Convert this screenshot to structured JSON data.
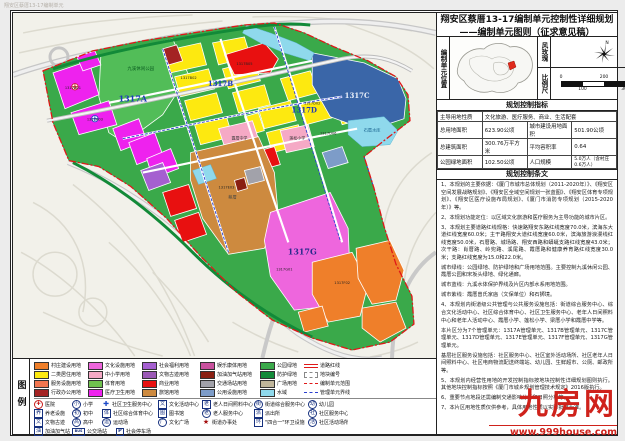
{
  "corner_note": "翔安区蔡厝13-17编制单元",
  "title": {
    "line1": "翔安区蔡厝13-17编制单元控制性详细规划",
    "line2": "——编制单元图则（征求意见稿）"
  },
  "panels": {
    "unit_location_label": "编制单元位置",
    "wind_rose_label": "风玫瑰",
    "north_label": "N",
    "scale_label": "比例尺",
    "scale_ticks_top": [
      "0",
      "200",
      "400m"
    ],
    "scale_ticks_bottom": [
      "100",
      "300"
    ]
  },
  "indicators": {
    "title": "规划控制指标",
    "rows": [
      [
        {
          "t": "主导用地性质"
        },
        {
          "t": "文化旅游、医疗服务、商业、生活配套",
          "span": 3
        }
      ],
      [
        {
          "t": "总用地面积"
        },
        {
          "t": "623.90公顷"
        },
        {
          "t": "城市建设用地面积"
        },
        {
          "t": "501.90公顷"
        }
      ],
      [
        {
          "t": "总建筑面积"
        },
        {
          "t": "300.76万平方米"
        },
        {
          "t": "平均容积率"
        },
        {
          "t": "0.64"
        }
      ],
      [
        {
          "t": "公园绿地面积"
        },
        {
          "t": "102.50公顷"
        },
        {
          "t": "人口规模"
        },
        {
          "t": "5.0万人（含村庄0.6万人）",
          "small": true
        }
      ]
    ]
  },
  "provisions": {
    "title": "规划控制条文",
    "paragraphs": [
      "1、本规划的主要依据：《厦门市城市总体规划（2011-2020年）》、《翔安区空间发展战略规划》、《翔安区全域空间规划一张蓝图》、《翔安区体育专项规划》、《翔安区医疗设施布局规划》、《厦门市消防专项规划（2015-2020年）》等。",
      "2、本规划功能定位：以区域文化旅游和医疗服务为主导功能的城市片区。",
      "3、本规划主要道路红线规格：快速路翔安东路红线宽度70.0米，滨海东大道红线宽度60.0米；主干路翔安大道红线宽度60.0米，滨海旅游浪漫线红线宽度50.0米，石厝路、城场路、翔安西路和蟒蜒支路红线宽度43.0米；次干路：肖厝路、岭兜路、溪尾路、霞厝路和健康养育路红线宽度30.0米；支路红线宽度为15.0和22.0米。",
      "城市绿线：公园绿地、防护绿地和广场用地范围。主要控制九溪休闲公园、霞厝公园和宋坂头绿地、绿化通廊。",
      "城市蓝线：九溪水体保护界线及片区内部水系用地范围。",
      "城市紫线：霞厝曾氏家庙（文保单位）和石狮境。",
      "4、本规划内街道级公共管理与公共服务设施包括：街道综合服务中心、综合文化活动中心、社区综合体育中心、社区卫生服务中心、老年人日间照料中心和老年人活动中心、霞厝小学、莲松小学、梁厝小学和霞厝中学等。",
      "本片区分为7个管理单元：1317A管理单元、1317B管理单元、1317C管理单元、1317D管理单元、1317E管理单元、1317F管理单元、1317G管理单元。",
      "基层社区服务设施包括：社区服务中心、社区室外活动场所、社区老年人日间照料中心、社区电商物流配送终端站、幼儿园、生鲜超市、公厕、邮政所等。",
      "5、本规划内经营性用地的开发控制指标按地块控制性详细规划图则执行。其他地块控制指标按照《厦门市城乡规划管理技术规定》2016版执行。",
      "6、重要节点地段还需编制交通影响分析和日照分析等。",
      "7、本片区用地性质仅供参考，具体用地性质以实际批准为准。"
    ]
  },
  "legend": {
    "side_label": "图例",
    "color_rows": [
      [
        {
          "label": "村庄建设用地",
          "color": "#ef7f2a",
          "type": "fill",
          "w": 54
        },
        {
          "label": "文化设施用地",
          "color": "#ee66dd",
          "type": "fill",
          "w": 54
        },
        {
          "label": "社会福利用地",
          "color": "#a55fd0",
          "type": "fill",
          "w": 58
        },
        {
          "label": "娱乐康体用地",
          "color": "#c9519e",
          "type": "fill",
          "w": 60
        },
        {
          "label": "公园绿地",
          "color": "#3aa94a",
          "type": "fill",
          "w": 44
        },
        {
          "label": "道路红线",
          "color": "#e01818",
          "type": "road-line",
          "w": 54
        }
      ],
      [
        {
          "label": "二类居住用地",
          "color": "#fde910",
          "type": "fill",
          "w": 54
        },
        {
          "label": "中小学用地",
          "color": "#f5a9c5",
          "type": "fill",
          "w": 54
        },
        {
          "label": "文物古迹用地",
          "color": "#9b59b6",
          "type": "fill",
          "w": 58
        },
        {
          "label": "加油加气站用地",
          "color": "#8a1f12",
          "type": "fill",
          "w": 60
        },
        {
          "label": "防护绿地",
          "color": "#128a38",
          "type": "fill",
          "w": 44
        },
        {
          "label": "地块编号",
          "color": "#888888",
          "type": "dash-box",
          "w": 54
        }
      ],
      [
        {
          "label": "服务设施用地",
          "color": "#f2764f",
          "type": "fill",
          "w": 54
        },
        {
          "label": "体育用地",
          "color": "#6fc24e",
          "type": "fill",
          "w": 54
        },
        {
          "label": "商业用地",
          "color": "#e81010",
          "type": "fill",
          "w": 58
        },
        {
          "label": "交通场站用地",
          "color": "#a2a2aa",
          "type": "fill",
          "w": 60
        },
        {
          "label": "广场用地",
          "color": "#c0b69b",
          "type": "fill",
          "w": 44
        },
        {
          "label": "编制单元范围",
          "color": "#e01818",
          "type": "dashdot-red",
          "w": 54
        }
      ],
      [
        {
          "label": "行政办公用地",
          "color": "#a42323",
          "type": "fill",
          "w": 54
        },
        {
          "label": "医疗卫生用地",
          "color": "#ee22ee",
          "type": "fill",
          "w": 54
        },
        {
          "label": "旅馆用地",
          "color": "#cd8a3f",
          "type": "fill",
          "w": 58
        },
        {
          "label": "公用设施用地",
          "color": "#7d9cc8",
          "type": "fill",
          "w": 60
        },
        {
          "label": "水域",
          "color": "#8fd9ec",
          "type": "fill",
          "w": 44
        },
        {
          "label": "管理单元界线",
          "color": "#2b3fd0",
          "type": "dash-blue",
          "w": 54
        }
      ]
    ],
    "icon_rows": [
      [
        {
          "label": "医院",
          "shape": "cross-circle",
          "glyph": "✚",
          "w": 38
        },
        {
          "label": "小学",
          "shape": "circle",
          "glyph": "小",
          "w": 30
        },
        {
          "label": "社区卫生服务中心",
          "shape": "cross",
          "glyph": "✚",
          "w": 56
        },
        {
          "label": "文化活动中心",
          "shape": "square",
          "glyph": "文",
          "w": 44
        },
        {
          "label": "老人日间照料中心",
          "shape": "square",
          "glyph": "老",
          "w": 52
        },
        {
          "label": "街道综合服务中心",
          "shape": "circle",
          "glyph": "街",
          "w": 54
        },
        {
          "label": "幼儿园",
          "shape": "circle",
          "glyph": "幼",
          "w": 40
        }
      ],
      [
        {
          "label": "养老设施",
          "shape": "square",
          "glyph": "养",
          "w": 38
        },
        {
          "label": "初中",
          "shape": "circle",
          "glyph": "初",
          "w": 30
        },
        {
          "label": "社区综合体育中心",
          "shape": "square",
          "glyph": "体",
          "w": 56
        },
        {
          "label": "图书馆",
          "shape": "square",
          "glyph": "图",
          "w": 44
        },
        {
          "label": "老人服务中心",
          "shape": "circle",
          "glyph": "老",
          "w": 52
        },
        {
          "label": "派出所",
          "shape": "square",
          "glyph": "派",
          "w": 54
        },
        {
          "label": "社区服务中心",
          "shape": "circle",
          "glyph": "社",
          "w": 40
        }
      ],
      [
        {
          "label": "文物古迹",
          "shape": "square",
          "glyph": "文",
          "w": 38
        },
        {
          "label": "高中",
          "shape": "circle",
          "glyph": "高",
          "w": 30
        },
        {
          "label": "运动场",
          "shape": "circle",
          "glyph": "运",
          "w": 56
        },
        {
          "label": "文化广场",
          "shape": "circle",
          "glyph": "广",
          "w": 44
        },
        {
          "label": "街道办事处",
          "shape": "star",
          "glyph": "★",
          "w": 52
        },
        {
          "label": "\"四合一\"环卫设施",
          "shape": "square",
          "glyph": "环",
          "w": 54
        },
        {
          "label": "社区活动场所",
          "shape": "circle",
          "glyph": "活",
          "w": 40
        }
      ],
      [
        {
          "label": "加油加气站",
          "shape": "square",
          "glyph": "油",
          "w": 38
        },
        {
          "label": "公交场站",
          "shape": "bus",
          "glyph": "BUS",
          "w": 44
        },
        {
          "label": "社会停车场",
          "shape": "p",
          "glyph": "P",
          "w": 44
        }
      ]
    ]
  },
  "map": {
    "labels": [
      {
        "t": "1317A",
        "x": 120,
        "y": 89,
        "s": 8,
        "c": "#1c39bb",
        "b": 1
      },
      {
        "t": "1317B",
        "x": 208,
        "y": 73,
        "s": 7,
        "c": "#1c39bb",
        "b": 1
      },
      {
        "t": "1317C",
        "x": 345,
        "y": 85,
        "s": 7,
        "c": "#eaf0fa",
        "b": 1
      },
      {
        "t": "1317D",
        "x": 292,
        "y": 100,
        "s": 7,
        "c": "#1c39bb",
        "b": 1
      },
      {
        "t": "1317G",
        "x": 290,
        "y": 242,
        "s": 8,
        "c": "#2a2a8c",
        "b": 1
      },
      {
        "t": "九溪休闲公园",
        "x": 128,
        "y": 57,
        "s": 4.5,
        "c": "#0a5c20"
      },
      {
        "t": "石厝水库",
        "x": 360,
        "y": 119,
        "s": 4.2,
        "c": "#155e8a"
      },
      {
        "t": "霞厝中学",
        "x": 227,
        "y": 127,
        "s": 4,
        "c": "#333333"
      },
      {
        "t": "莲松小学",
        "x": 285,
        "y": 127,
        "s": 4,
        "c": "#333333"
      },
      {
        "t": "蔡厝",
        "x": 220,
        "y": 186,
        "s": 4.2,
        "c": "#444444"
      },
      {
        "t": "1317A01",
        "x": 60,
        "y": 76,
        "s": 3.6,
        "c": "#222222"
      },
      {
        "t": "1317A03",
        "x": 82,
        "y": 108,
        "s": 3.6,
        "c": "#222222"
      },
      {
        "t": "1317B02",
        "x": 176,
        "y": 66,
        "s": 3.6,
        "c": "#222222"
      },
      {
        "t": "1317B05",
        "x": 232,
        "y": 52,
        "s": 3.6,
        "c": "#222222"
      },
      {
        "t": "1317D02",
        "x": 300,
        "y": 92,
        "s": 3.6,
        "c": "#222222"
      },
      {
        "t": "1317D06",
        "x": 316,
        "y": 122,
        "s": 3.6,
        "c": "#222222"
      },
      {
        "t": "1317E03",
        "x": 214,
        "y": 176,
        "s": 3.6,
        "c": "#222222"
      },
      {
        "t": "1317F02",
        "x": 330,
        "y": 272,
        "s": 3.6,
        "c": "#222222"
      },
      {
        "t": "1317G01",
        "x": 272,
        "y": 258,
        "s": 3.6,
        "c": "#222222"
      }
    ]
  },
  "watermark": {
    "name": "九房网",
    "url": "www.999house.com"
  }
}
